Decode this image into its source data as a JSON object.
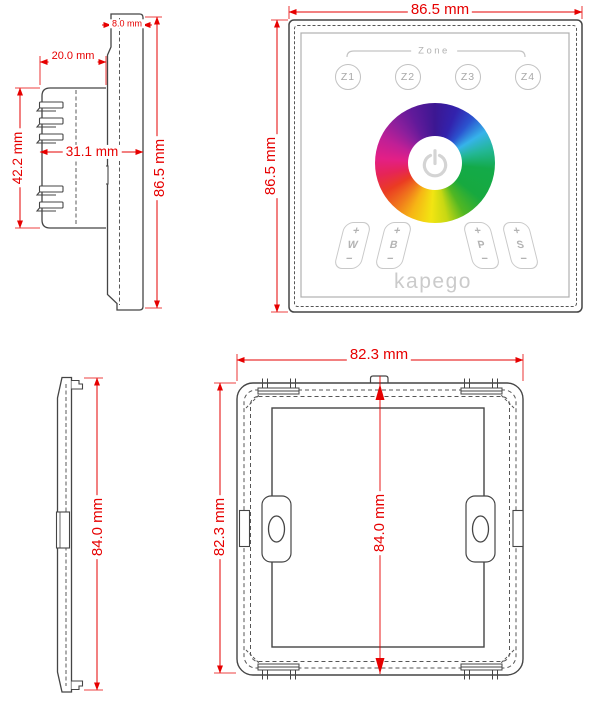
{
  "colors": {
    "dimension_red": "#e60000",
    "outline_dark": "#454545",
    "panel_gray": "#c6c6c6"
  },
  "views": {
    "device_side": {
      "glass_thickness": "8.0 mm",
      "box_depth": "20.0 mm",
      "total_depth": "31.1 mm",
      "box_height": "42.2 mm",
      "height": "86.5 mm"
    },
    "device_front": {
      "width": "86.5 mm",
      "height": "86.5 mm",
      "zone_label": "Zone",
      "zones": [
        "Z1",
        "Z2",
        "Z3",
        "Z4"
      ],
      "channels": [
        {
          "plus": "+",
          "letter": "W",
          "minus": "−"
        },
        {
          "plus": "+",
          "letter": "B",
          "minus": "−"
        },
        {
          "plus": "+",
          "letter": "P",
          "minus": "−"
        },
        {
          "plus": "+",
          "letter": "S",
          "minus": "−"
        }
      ],
      "color_wheel": {
        "type": "rgb-color-wheel",
        "hues_clockwise_from_top": [
          "purple",
          "blue",
          "cyan",
          "green",
          "yellow",
          "orange",
          "red",
          "magenta"
        ]
      },
      "power_icon": "power-icon",
      "brand": "kapego"
    },
    "frame_side": {
      "height": "84.0 mm"
    },
    "frame_back": {
      "width": "82.3 mm",
      "height_outer": "82.3 mm",
      "height_inner": "84.0 mm"
    }
  }
}
